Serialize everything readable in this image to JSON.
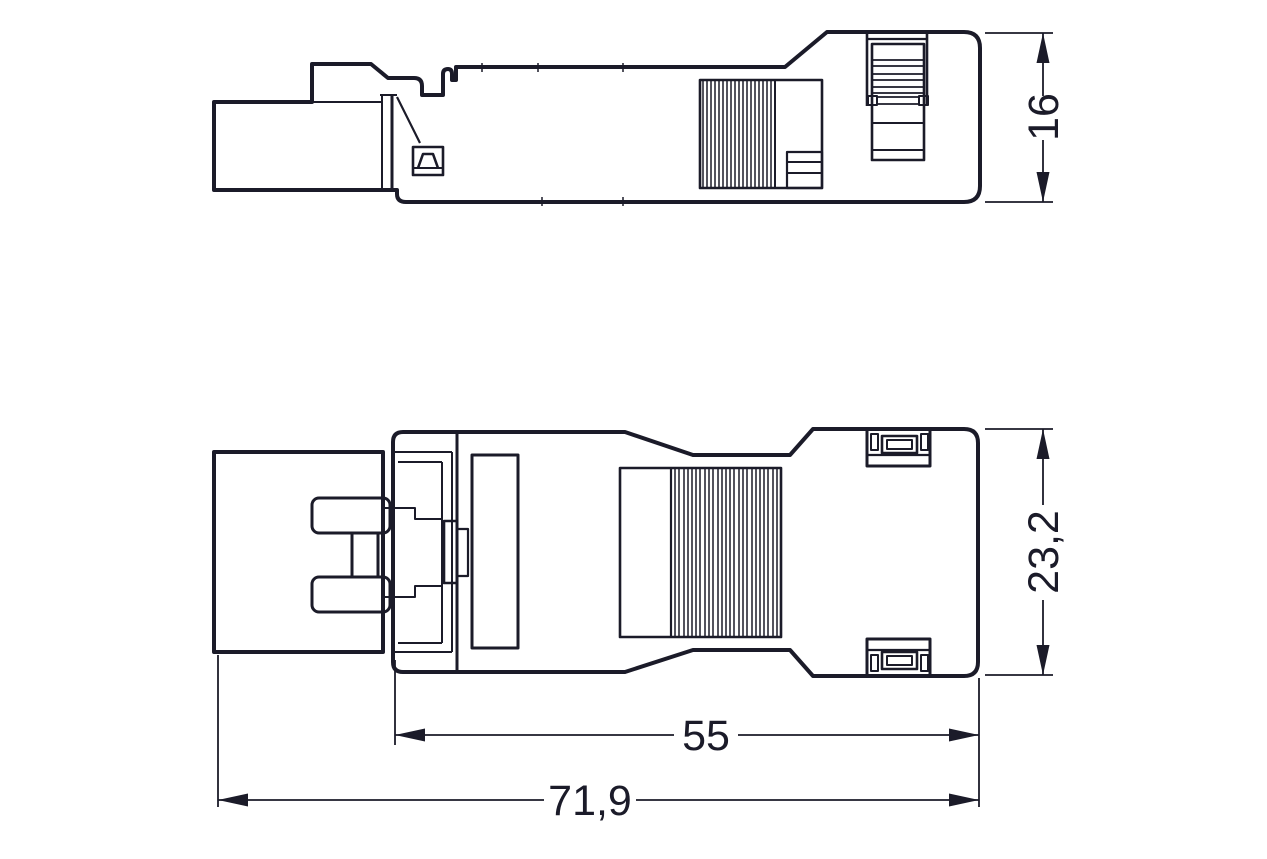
{
  "drawing": {
    "ink_color": "#1b1b29",
    "background_color": "#ffffff",
    "dimensions": {
      "side_view_height": "16",
      "plan_view_height": "23,2",
      "housing_length": "55",
      "overall_length": "71,9"
    }
  }
}
